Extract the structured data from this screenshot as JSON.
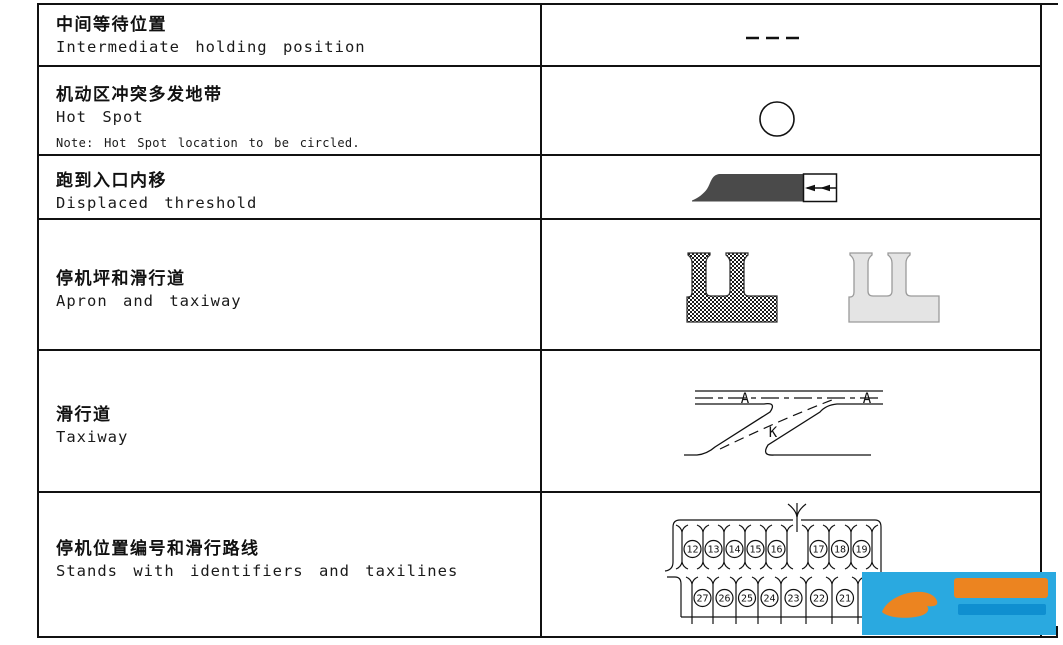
{
  "table": {
    "rows": [
      {
        "zh": "中间等待位置",
        "en": "Intermediate holding position",
        "symbol": "dashed-line"
      },
      {
        "zh": "机动区冲突多发地带",
        "en": "Hot Spot",
        "note": "Note: Hot Spot location to be circled.",
        "symbol": "circle"
      },
      {
        "zh": "跑到入口内移",
        "en": "Displaced threshold",
        "symbol": "displaced-threshold"
      },
      {
        "zh": "停机坪和滑行道",
        "en": "Apron and taxiway",
        "symbol": "apron-and-taxiway"
      },
      {
        "zh": "滑行道",
        "en": "Taxiway",
        "symbol": "taxiway-junction",
        "labels": {
          "main_1": "A",
          "main_2": "A",
          "branch": "K"
        }
      },
      {
        "zh": "停机位置编号和滑行路线",
        "en": "Stands with identifiers and taxilines",
        "symbol": "stands-diagram",
        "stands": {
          "top_left": [
            "12",
            "13",
            "14",
            "15",
            "16"
          ],
          "top_right": [
            "17",
            "18",
            "19"
          ],
          "bottom": [
            "27",
            "26",
            "25",
            "24",
            "23",
            "22",
            "21"
          ]
        }
      }
    ]
  },
  "colors": {
    "line": "#111111",
    "threshold_fill": "#4a4a4a",
    "apron_gray": "#e4e4e4",
    "logo_blue": "#2aa9e0",
    "logo_orange": "#ec8420",
    "logo_text_blue": "#0f8fd0"
  }
}
